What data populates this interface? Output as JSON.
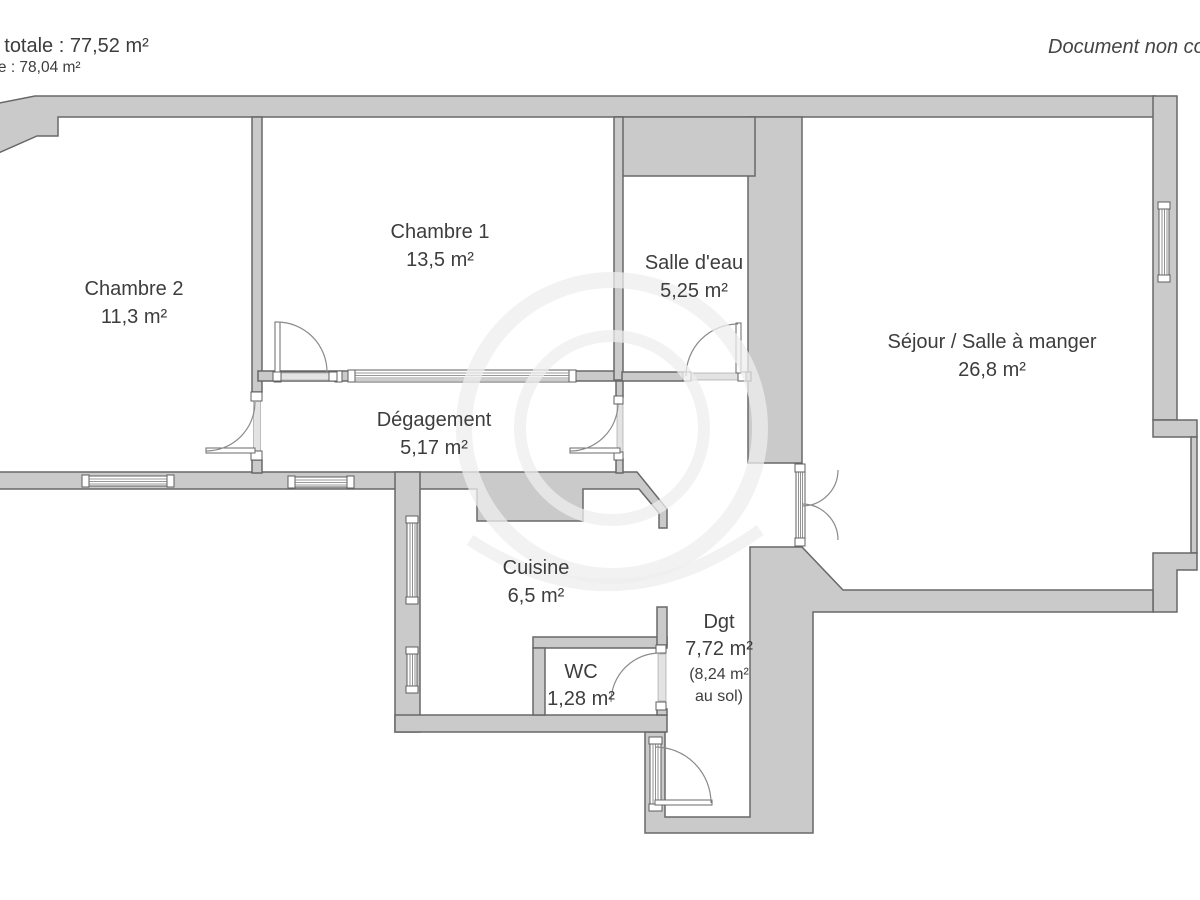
{
  "header": {
    "left_line1": "cie loi Carrez totale :  77,52 m²",
    "left_line2": "e au sol totale :  78,04 m²",
    "right_note": "Document non contractuel"
  },
  "rooms": [
    {
      "name": "Chambre 2",
      "area": "11,3 m²"
    },
    {
      "name": "Chambre 1",
      "area": "13,5 m²"
    },
    {
      "name": "Salle d'eau",
      "area": "5,25 m²"
    },
    {
      "name": "Séjour / Salle à manger",
      "area": "26,8 m²"
    },
    {
      "name": "Dégagement",
      "area": "5,17 m²"
    },
    {
      "name": "Cuisine",
      "area": "6,5 m²"
    },
    {
      "name": "WC",
      "area": "1,28 m²"
    },
    {
      "name": "Dgt",
      "area": "7,72 m²",
      "area_note_1": "(8,24 m²",
      "area_note_2": "au sol)"
    }
  ],
  "colors": {
    "wall_fill": "#cacaca",
    "wall_line": "#686868",
    "text": "#3d3d3d",
    "threshold": "#e3e3e3",
    "watermark": "#ededed"
  }
}
